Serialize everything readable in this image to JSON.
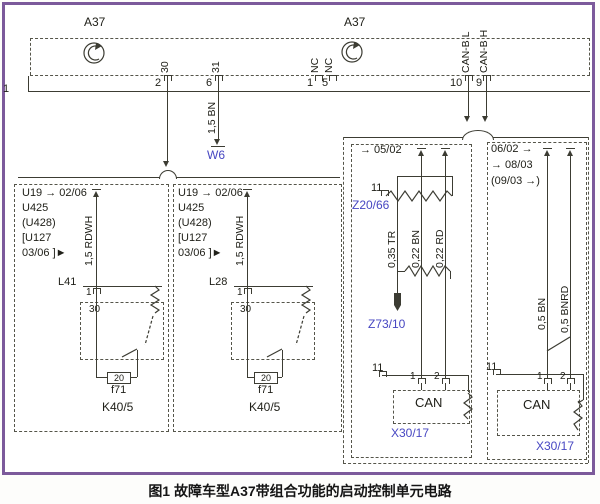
{
  "colors": {
    "line": "#3c3c33",
    "blue_label": "#4747c2",
    "frame_purple": "#7c5a9b"
  },
  "caption": "图1 故障车型A37带组合功能的启动控制单元电路",
  "a37": {
    "left_label": "A37",
    "right_label": "A37",
    "rail": "1",
    "pin2": "2",
    "pin2_signal": "30",
    "pin6": "6",
    "pin6_signal": "31",
    "pin1": "1",
    "pin1_signal": "NC",
    "pin5": "5",
    "pin5_signal": "NC",
    "pin10": "10",
    "pin10_signal": "CAN-B L",
    "pin9": "9",
    "pin9_signal": "CAN-B H"
  },
  "ground": {
    "wire": "1,5 BN",
    "label": "W6"
  },
  "module1": {
    "code1": "U19 → 02/06",
    "code2": "U425",
    "code3": "(U428)",
    "code4": "[U127",
    "code5": "03/06 ]►",
    "wire": "1,5 RDWH",
    "relay": "L41",
    "pin": "1",
    "terminal": "30",
    "fuse": "20",
    "fuse_name": "f71",
    "unit": "K40/5"
  },
  "module2": {
    "code1": "U19 → 02/06",
    "code2": "U425",
    "code3": "(U428)",
    "code4": "[U127",
    "code5": "03/06 ]►",
    "wire": "1,5 RDWH",
    "relay": "L28",
    "pin": "1",
    "terminal": "30",
    "fuse": "20",
    "fuse_name": "f71",
    "unit": "K40/5"
  },
  "block_a": {
    "date": "→ 05/02",
    "pin": "11",
    "splice": "Z20/66",
    "wire1": "0,35 TR",
    "wire2": "0,22 BN",
    "wire3": "0,22 RD",
    "connector": "Z73/10",
    "shield_pin": "11",
    "pin1": "1",
    "pin2": "2",
    "bus": "CAN",
    "plug": "X30/17"
  },
  "block_b": {
    "date1": "06/02 →",
    "date2": "→ 08/03",
    "date3": "(09/03 →)",
    "wire1": "0,5 BN",
    "wire2": "0,5 BNRD",
    "shield_pin": "11",
    "pin1": "1",
    "pin2": "2",
    "bus": "CAN",
    "plug": "X30/17"
  }
}
